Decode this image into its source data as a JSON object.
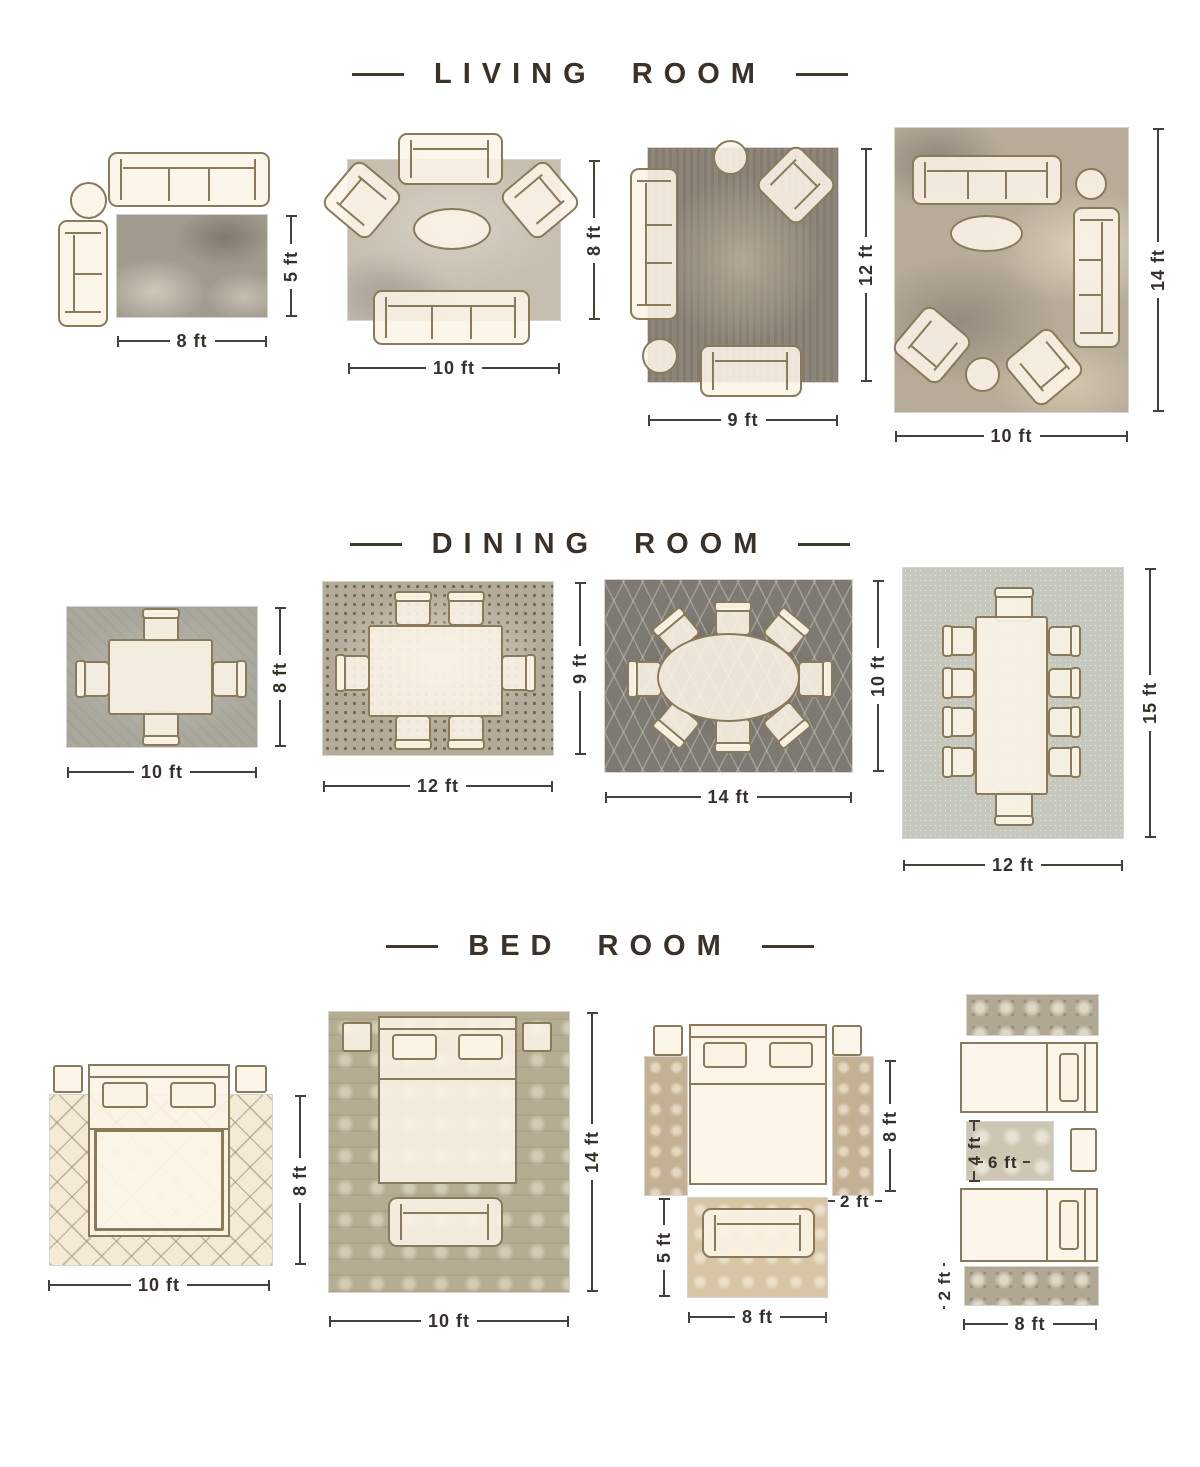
{
  "palette": {
    "background": "#ffffff",
    "title_color": "#3a3128",
    "dimension_color": "#35302a",
    "furniture_fill": "#fcf5e7",
    "furniture_outline": "#8a7a5c"
  },
  "sections": [
    {
      "title": "LIVING ROOM",
      "layouts": [
        {
          "name": "living-8x5",
          "w": "8 ft",
          "h": "5 ft",
          "furniture": [
            "sofa",
            "round-side-table",
            "loveseat",
            "rug"
          ]
        },
        {
          "name": "living-10x8",
          "w": "10 ft",
          "h": "8 ft",
          "furniture": [
            "loveseat",
            "armchair",
            "armchair",
            "oval-coffee-table",
            "sofa",
            "rug"
          ]
        },
        {
          "name": "living-9x12",
          "w": "9 ft",
          "h": "12 ft",
          "furniture": [
            "round-side-table",
            "armchair",
            "sofa",
            "round-side-table",
            "loveseat",
            "rug"
          ]
        },
        {
          "name": "living-10x14",
          "w": "10 ft",
          "h": "14 ft",
          "furniture": [
            "sofa",
            "round-side-table",
            "oval-coffee-table",
            "sofa",
            "armchair",
            "armchair",
            "round-side-table",
            "rug"
          ]
        }
      ]
    },
    {
      "title": "DINING ROOM",
      "layouts": [
        {
          "name": "dining-10x8",
          "w": "10 ft",
          "h": "8 ft",
          "furniture": [
            "dining-table",
            "4 chairs",
            "rug"
          ]
        },
        {
          "name": "dining-12x9",
          "w": "12 ft",
          "h": "9 ft",
          "furniture": [
            "dining-table",
            "6 chairs",
            "rug"
          ]
        },
        {
          "name": "dining-14x10",
          "w": "14 ft",
          "h": "10 ft",
          "furniture": [
            "oval-dining-table",
            "8 chairs",
            "rug"
          ]
        },
        {
          "name": "dining-12x15",
          "w": "12 ft",
          "h": "15 ft",
          "furniture": [
            "dining-table",
            "10 chairs",
            "rug"
          ]
        }
      ]
    },
    {
      "title": "BED ROOM",
      "layouts": [
        {
          "name": "bed-10x8",
          "w": "10 ft",
          "h": "8 ft",
          "furniture": [
            "bed",
            "nightstand",
            "nightstand",
            "rug"
          ]
        },
        {
          "name": "bed-10x14",
          "w": "10 ft",
          "h": "14 ft",
          "furniture": [
            "bed",
            "nightstand",
            "nightstand",
            "bench",
            "rug"
          ]
        },
        {
          "name": "bed-side-runners",
          "bed_h": "8 ft",
          "runner_w": "2 ft",
          "rug_h": "5 ft",
          "rug_w": "8 ft",
          "furniture": [
            "bed",
            "nightstand",
            "nightstand",
            "runner",
            "runner",
            "loveseat",
            "rug"
          ]
        },
        {
          "name": "twin-beds-runners",
          "rug_h": "4 ft",
          "rug_w": "6 ft",
          "runner_h": "2 ft",
          "runner_w": "8 ft",
          "furniture": [
            "runner",
            "twin-bed",
            "rug",
            "nightstand",
            "twin-bed",
            "runner"
          ]
        }
      ]
    }
  ]
}
